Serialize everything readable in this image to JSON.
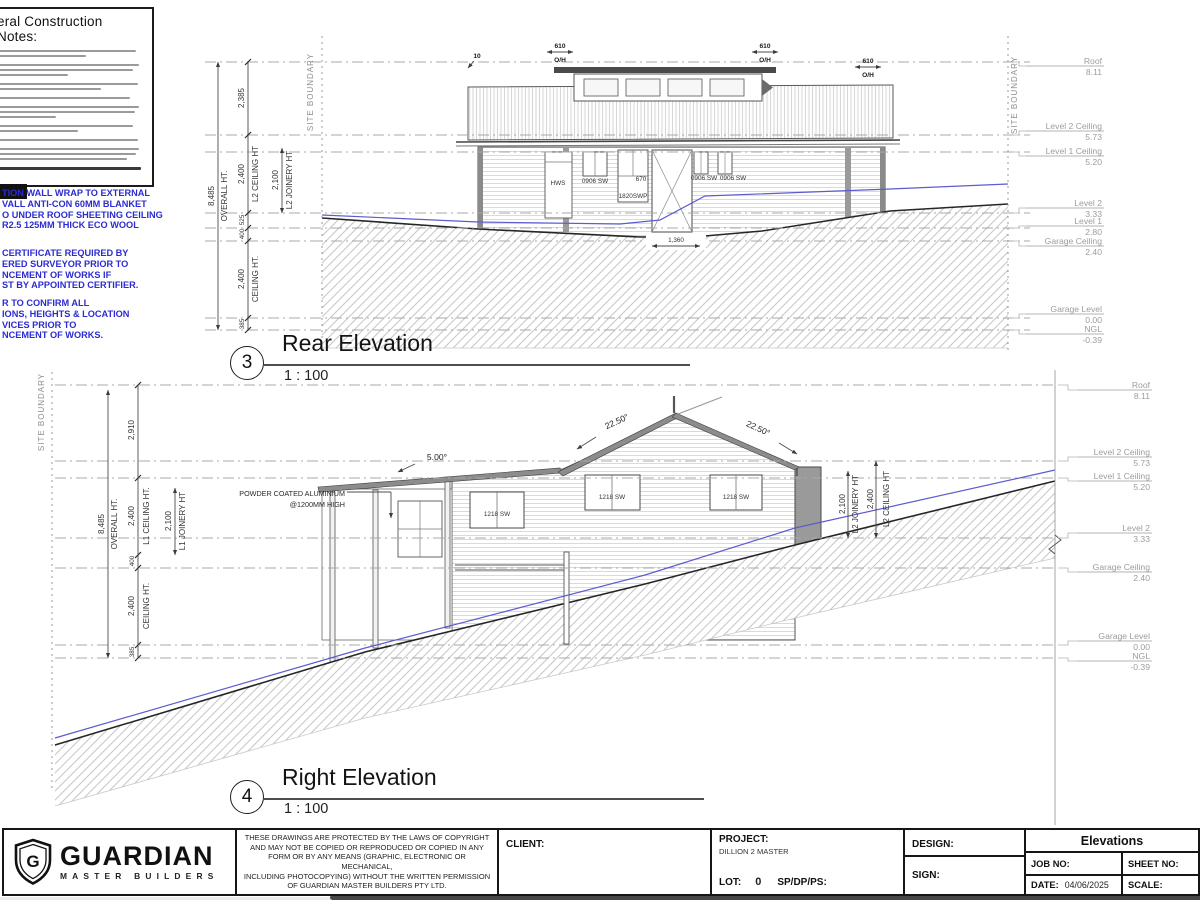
{
  "notes": {
    "title": "eral Construction Notes:"
  },
  "blue_notes": {
    "g1l1": "TION WALL WRAP TO EXTERNAL",
    "g1l2": "VALL ANTI-CON 60MM BLANKET",
    "g1l3": "O UNDER ROOF SHEETING CEILING",
    "g1l4": "R2.5 125MM THICK ECO WOOL",
    "g2l1": "CERTIFICATE REQUIRED BY",
    "g2l2": "ERED SURVEYOR PRIOR TO",
    "g2l3": "NCEMENT OF WORKS IF",
    "g2l4": "ST BY APPOINTED CERTIFIER.",
    "g3l1": "R TO CONFIRM ALL",
    "g3l2": "IONS, HEIGHTS & LOCATION",
    "g3l3": "VICES PRIOR TO",
    "g3l4": "NCEMENT OF WORKS."
  },
  "rear": {
    "number": "3",
    "title": "Rear Elevation",
    "scale": "1 : 100",
    "site_boundary_left": "SITE BOUNDARY",
    "site_boundary_right": "SITE BOUNDARY",
    "levels": [
      {
        "name": "Roof",
        "value": "8.11"
      },
      {
        "name": "Level 2 Ceiling",
        "value": "5.73"
      },
      {
        "name": "Level 1 Ceiling",
        "value": "5.20"
      },
      {
        "name": "Level 2",
        "value": "3.33"
      },
      {
        "name": "Level 1",
        "value": "2.80"
      },
      {
        "name": "Garage Ceiling",
        "value": "2.40"
      },
      {
        "name": "Garage Level",
        "value": "0.00"
      },
      {
        "name": "NGL",
        "value": "-0.39"
      }
    ],
    "dims": {
      "overall": "8,485",
      "overall_label": "OVERALL HT.",
      "seg_roof": "2,385",
      "l2_ceiling": "2,400",
      "l2_ceiling_label": "L2 CEILING HT",
      "seg_525": "525",
      "seg_400": "400",
      "garage_ceiling": "2,400",
      "garage_ceiling_label": "CEILING HT.",
      "seg_ngl": "385",
      "joinery": "2,100",
      "joinery_label": "L2 JOINERY HT",
      "overhang": "610",
      "overhang_label": "O/H",
      "eave_tick": "10",
      "door_width": "1,360"
    },
    "tags": {
      "hws": "HWS",
      "w1": "0906 SW",
      "w2": "1820SWP",
      "door": "670",
      "w3": "0906 SW",
      "w4": "0906 SW"
    }
  },
  "right": {
    "number": "4",
    "title": "Right Elevation",
    "scale": "1 : 100",
    "site_boundary": "SITE BOUNDARY",
    "levels": [
      {
        "name": "Roof",
        "value": "8.11"
      },
      {
        "name": "Level 2 Ceiling",
        "value": "5.73"
      },
      {
        "name": "Level 1 Ceiling",
        "value": "5.20"
      },
      {
        "name": "Level 2",
        "value": "3.33"
      },
      {
        "name": "Garage Ceiling",
        "value": "2.40"
      },
      {
        "name": "Garage Level",
        "value": "0.00"
      },
      {
        "name": "NGL",
        "value": "-0.39"
      }
    ],
    "dims": {
      "overall": "8,485",
      "overall_label": "OVERALL HT.",
      "seg_roof": "2,910",
      "l1_ceiling": "2,400",
      "l1_ceiling_label": "L1 CEILING HT.",
      "seg_400": "400",
      "garage_ceiling": "2,400",
      "garage_ceiling_label": "CEILING HT.",
      "seg_ngl": "385",
      "joinery": "2,100",
      "joinery_label": "L1 JOINERY HT",
      "r_joinery": "2,100",
      "r_joinery_label": "L2 JOINERY HT",
      "r_ceiling": "2,400",
      "r_ceiling_label": "L2 CEILING HT"
    },
    "angles": {
      "low": "5.00°",
      "left": "22.50°",
      "right": "22.50°"
    },
    "annotation": {
      "line1": "POWDER COATED ALUMINIUM",
      "line2": "@1200MM HIGH"
    },
    "tags": {
      "w1": "1218 SW",
      "w2": "1218 SW",
      "w3": "1218 SW"
    }
  },
  "logo": {
    "initial": "G",
    "name": "GUARDIAN",
    "tagline": "MASTER BUILDERS"
  },
  "titleblock": {
    "copyright": {
      "l1": "THESE DRAWINGS ARE PROTECTED BY THE LAWS OF COPYRIGHT",
      "l2": "AND MAY NOT BE COPIED OR REPRODUCED OR COPIED IN ANY",
      "l3": "FORM OR BY ANY MEANS (GRAPHIC, ELECTRONIC OR MECHANICAL,",
      "l4": "INCLUDING PHOTOCOPYING) WITHOUT THE WRITTEN PERMISSION",
      "l5": "OF GUARDIAN MASTER BUILDERS PTY LTD."
    },
    "client_label": "CLIENT:",
    "project_label": "PROJECT:",
    "project_value": "DILLION 2 MASTER",
    "lot_label": "LOT:",
    "lot_value": "0",
    "sp_label": "SP/DP/PS:",
    "design_label": "DESIGN:",
    "sign_label": "SIGN:",
    "sheet_title": "Elevations",
    "job_label": "JOB NO:",
    "sheet_label": "SHEET NO:",
    "date_label": "DATE:",
    "date_value": "04/06/2025",
    "scale_label": "SCALE:"
  },
  "colors": {
    "note_blue": "#2b2bd0",
    "ngl_blue": "#5c5ccf",
    "line_dark": "#262626"
  }
}
